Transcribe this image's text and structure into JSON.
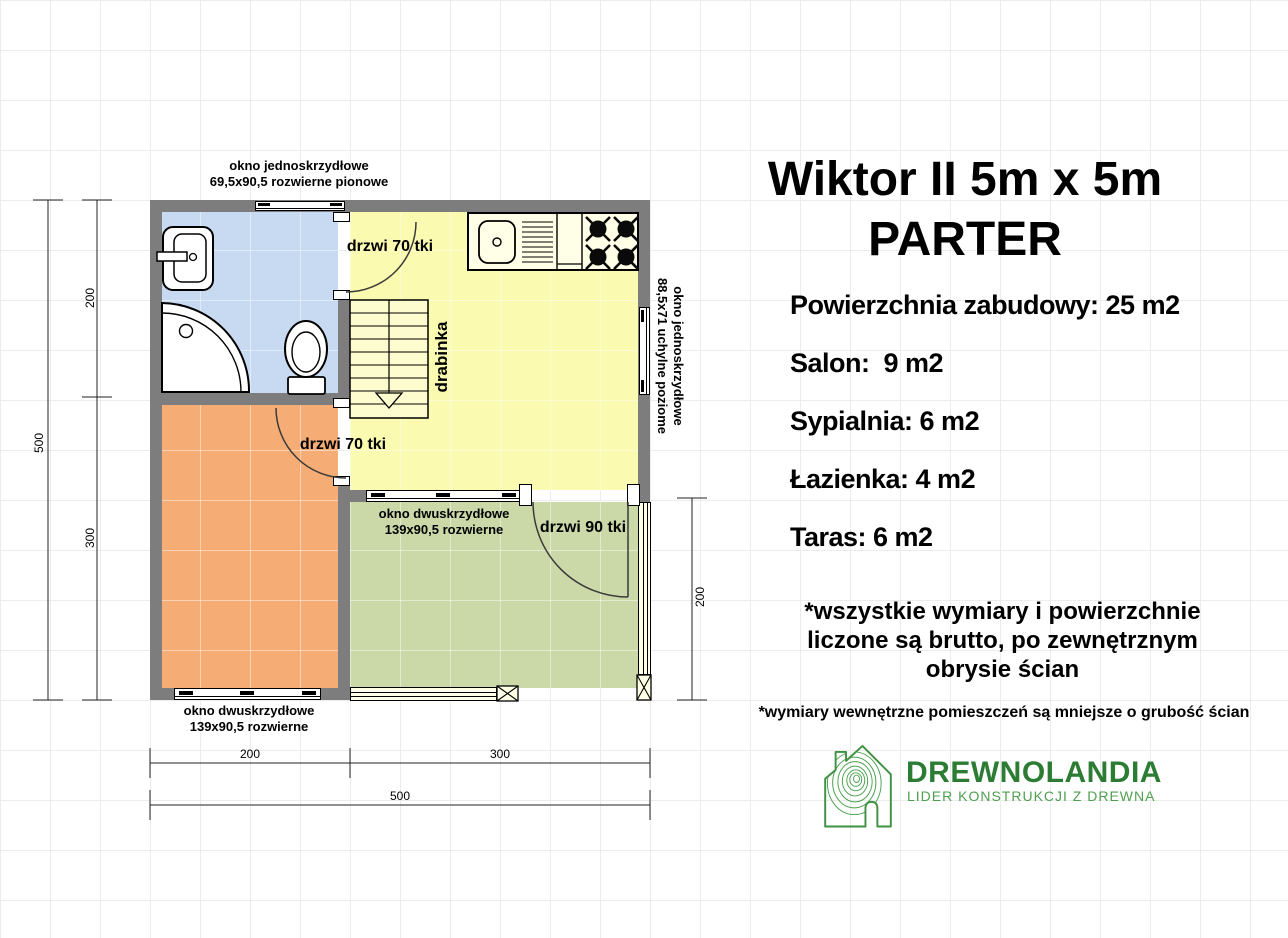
{
  "info_panel": {
    "title_line1": "Wiktor II 5m x 5m",
    "title_line2": "PARTER",
    "areas": [
      "Powierzchnia zabudowy: 25 m2",
      "Salon:  9 m2",
      "Sypialnia: 6 m2",
      "Łazienka: 4 m2",
      "Taras: 6 m2"
    ],
    "note_bold_line1": "*wszystkie wymiary i powierzchnie",
    "note_bold_line2": "liczone są brutto, po zewnętrznym",
    "note_bold_line3": "obrysie ścian",
    "note_small": "*wymiary wewnętrzne pomieszczeń są mniejsze o grubość ścian"
  },
  "logo": {
    "name": "DREWNOLANDIA",
    "tagline": "LIDER KONSTRUKCJI Z DREWNA",
    "brand_green": "#2c7c34",
    "tagline_green": "#4f9f50"
  },
  "floor_plan": {
    "labels": {
      "window_top_line1": "okno jednoskrzydłowe",
      "window_top_line2": "69,5x90,5 rozwierne pionowe",
      "window_right_line1": "okno jednoskrzydłowe",
      "window_right_line2": "88,5x71 uchylne poziome",
      "window_terrace_line1": "okno dwuskrzydłowe",
      "window_terrace_line2": "139x90,5 rozwierne",
      "window_bedroom_line1": "okno dwuskrzydłowe",
      "window_bedroom_line2": "139x90,5 rozwierne",
      "door_bathroom": "drzwi 70 tki",
      "door_bedroom": "drzwi 70 tki",
      "door_terrace": "drzwi 90 tki",
      "ladder": "drabinka"
    },
    "dimensions": {
      "overall_width": "500",
      "overall_height": "500",
      "left_upper": "200",
      "left_lower": "300",
      "bottom_left": "200",
      "bottom_right": "300",
      "right_terrace": "200"
    },
    "room_colors": {
      "bathroom": "#c7daf2",
      "salon_kitchen": "#fafab0",
      "bedroom": "#f5ac75",
      "terrace": "#cbd8a8",
      "wall": "#7d7d7d"
    }
  }
}
